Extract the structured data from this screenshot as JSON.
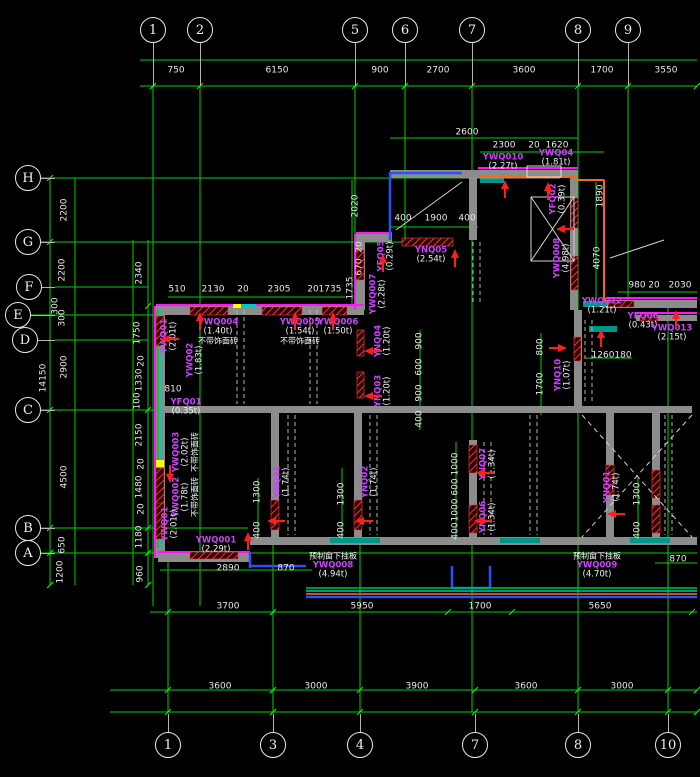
{
  "title": "precast-panel-floor-plan",
  "colors": {
    "background": "#000000",
    "grid_green": "#00d200",
    "wall_gray": "#8c8c8c",
    "wall_magenta": "#ff14ff",
    "label_purple": "#cf3fff",
    "dim_white": "#e8e8e8",
    "arrow_red": "#ff1e1e",
    "accent_blue": "#2850ff",
    "accent_orange": "#ff6414",
    "accent_cyan": "#00c8c8",
    "accent_yellow": "#ffff00"
  },
  "axes": {
    "top": [
      {
        "label": "1",
        "x": 153
      },
      {
        "label": "2",
        "x": 200
      },
      {
        "label": "5",
        "x": 355
      },
      {
        "label": "6",
        "x": 405
      },
      {
        "label": "7",
        "x": 472
      },
      {
        "label": "8",
        "x": 578
      },
      {
        "label": "9",
        "x": 628
      }
    ],
    "bottom": [
      {
        "label": "1",
        "x": 168
      },
      {
        "label": "3",
        "x": 273
      },
      {
        "label": "4",
        "x": 360
      },
      {
        "label": "7",
        "x": 475
      },
      {
        "label": "8",
        "x": 578
      },
      {
        "label": "10",
        "x": 668
      }
    ],
    "left": [
      {
        "label": "H",
        "x": 28,
        "y": 178
      },
      {
        "label": "G",
        "x": 28,
        "y": 242
      },
      {
        "label": "F",
        "x": 29,
        "y": 287
      },
      {
        "label": "E",
        "x": 18,
        "y": 315
      },
      {
        "label": "D",
        "x": 25,
        "y": 340
      },
      {
        "label": "C",
        "x": 28,
        "y": 410
      },
      {
        "label": "B",
        "x": 28,
        "y": 528
      },
      {
        "label": "A",
        "x": 28,
        "y": 553
      }
    ]
  },
  "dims": [
    {
      "t": "750",
      "x": 176,
      "y": 71
    },
    {
      "t": "6150",
      "x": 277,
      "y": 71
    },
    {
      "t": "900",
      "x": 380,
      "y": 71
    },
    {
      "t": "2700",
      "x": 438,
      "y": 71
    },
    {
      "t": "3600",
      "x": 524,
      "y": 71
    },
    {
      "t": "1700",
      "x": 602,
      "y": 71
    },
    {
      "t": "3550",
      "x": 666,
      "y": 71
    },
    {
      "t": "2600",
      "x": 467,
      "y": 133
    },
    {
      "t": "2300",
      "x": 504,
      "y": 146
    },
    {
      "t": "20",
      "x": 534,
      "y": 146
    },
    {
      "t": "1620",
      "x": 557,
      "y": 146
    },
    {
      "t": "400",
      "x": 403,
      "y": 219
    },
    {
      "t": "1900",
      "x": 436,
      "y": 219
    },
    {
      "t": "400",
      "x": 467,
      "y": 219
    },
    {
      "t": "510",
      "x": 177,
      "y": 290
    },
    {
      "t": "2130",
      "x": 213,
      "y": 290
    },
    {
      "t": "20",
      "x": 243,
      "y": 290
    },
    {
      "t": "2305",
      "x": 279,
      "y": 290
    },
    {
      "t": "20",
      "x": 313,
      "y": 290
    },
    {
      "t": "1735",
      "x": 330,
      "y": 290
    },
    {
      "t": "1735",
      "x": 351,
      "y": 288,
      "r": 1
    },
    {
      "t": "980",
      "x": 637,
      "y": 286
    },
    {
      "t": "20",
      "x": 654,
      "y": 286
    },
    {
      "t": "2030",
      "x": 680,
      "y": 286
    },
    {
      "t": "1260",
      "x": 603,
      "y": 356
    },
    {
      "t": "180",
      "x": 623,
      "y": 356
    },
    {
      "t": "810",
      "x": 173,
      "y": 390
    },
    {
      "t": "2890",
      "x": 228,
      "y": 569
    },
    {
      "t": "870",
      "x": 286,
      "y": 569
    },
    {
      "t": "870",
      "x": 678,
      "y": 560
    },
    {
      "t": "3700",
      "x": 228,
      "y": 607
    },
    {
      "t": "5950",
      "x": 362,
      "y": 607
    },
    {
      "t": "1700",
      "x": 480,
      "y": 607
    },
    {
      "t": "5650",
      "x": 600,
      "y": 607
    },
    {
      "t": "3600",
      "x": 220,
      "y": 687
    },
    {
      "t": "3000",
      "x": 316,
      "y": 687
    },
    {
      "t": "3900",
      "x": 417,
      "y": 687
    },
    {
      "t": "3600",
      "x": 526,
      "y": 687
    },
    {
      "t": "3000",
      "x": 622,
      "y": 687
    },
    {
      "t": "2200",
      "x": 65,
      "y": 210,
      "r": 1
    },
    {
      "t": "2200",
      "x": 63,
      "y": 270,
      "r": 1
    },
    {
      "t": "300",
      "x": 56,
      "y": 306,
      "r": 1
    },
    {
      "t": "300",
      "x": 63,
      "y": 318,
      "r": 1
    },
    {
      "t": "2900",
      "x": 65,
      "y": 367,
      "r": 1
    },
    {
      "t": "14150",
      "x": 44,
      "y": 378,
      "r": 1
    },
    {
      "t": "4500",
      "x": 65,
      "y": 477,
      "r": 1
    },
    {
      "t": "650",
      "x": 63,
      "y": 545,
      "r": 1
    },
    {
      "t": "1200",
      "x": 61,
      "y": 572,
      "r": 1
    },
    {
      "t": "2340",
      "x": 140,
      "y": 273,
      "r": 1
    },
    {
      "t": "1750",
      "x": 138,
      "y": 333,
      "r": 1
    },
    {
      "t": "20",
      "x": 142,
      "y": 361,
      "r": 1
    },
    {
      "t": "1330",
      "x": 140,
      "y": 380,
      "r": 1
    },
    {
      "t": "100",
      "x": 138,
      "y": 401,
      "r": 1
    },
    {
      "t": "2150",
      "x": 140,
      "y": 435,
      "r": 1
    },
    {
      "t": "20",
      "x": 142,
      "y": 464,
      "r": 1
    },
    {
      "t": "1480",
      "x": 140,
      "y": 487,
      "r": 1
    },
    {
      "t": "20",
      "x": 142,
      "y": 509,
      "r": 1
    },
    {
      "t": "1180",
      "x": 140,
      "y": 537,
      "r": 1
    },
    {
      "t": "960",
      "x": 141,
      "y": 574,
      "r": 1
    },
    {
      "t": "2020",
      "x": 356,
      "y": 206,
      "r": 1
    },
    {
      "t": "20",
      "x": 360,
      "y": 247,
      "r": 1
    },
    {
      "t": "670",
      "x": 360,
      "y": 267,
      "r": 1
    },
    {
      "t": "1890",
      "x": 601,
      "y": 196,
      "r": 1
    },
    {
      "t": "4070",
      "x": 598,
      "y": 258,
      "r": 1
    },
    {
      "t": "800",
      "x": 541,
      "y": 347,
      "r": 1
    },
    {
      "t": "1700",
      "x": 541,
      "y": 384,
      "r": 1
    },
    {
      "t": "900",
      "x": 420,
      "y": 341,
      "r": 1
    },
    {
      "t": "600",
      "x": 420,
      "y": 367,
      "r": 1
    },
    {
      "t": "900",
      "x": 420,
      "y": 393,
      "r": 1
    },
    {
      "t": "400",
      "x": 420,
      "y": 419,
      "r": 1
    },
    {
      "t": "1300",
      "x": 342,
      "y": 494,
      "r": 1
    },
    {
      "t": "400",
      "x": 342,
      "y": 530,
      "r": 1
    },
    {
      "t": "1000",
      "x": 456,
      "y": 464,
      "r": 1
    },
    {
      "t": "600",
      "x": 456,
      "y": 487,
      "r": 1
    },
    {
      "t": "1000",
      "x": 456,
      "y": 510,
      "r": 1
    },
    {
      "t": "400",
      "x": 456,
      "y": 531,
      "r": 1
    },
    {
      "t": "1300",
      "x": 258,
      "y": 492,
      "r": 1
    },
    {
      "t": "400",
      "x": 258,
      "y": 530,
      "r": 1
    },
    {
      "t": "1300",
      "x": 638,
      "y": 494,
      "r": 1
    },
    {
      "t": "400",
      "x": 638,
      "y": 530,
      "r": 1
    }
  ],
  "panel_labels": [
    {
      "name": "YWQ01",
      "weight": "(2.01t)",
      "x": 170,
      "y": 336,
      "r": 1
    },
    {
      "name": "YWQ004",
      "weight": "(1.40t)",
      "note": "不带饰面砖",
      "x": 218,
      "y": 332
    },
    {
      "name": "YWQ005",
      "weight": "(1.54t)",
      "note": "不带饰面砖",
      "x": 300,
      "y": 332
    },
    {
      "name": "YWQ006",
      "weight": "(1.50t)",
      "x": 338,
      "y": 328
    },
    {
      "name": "YWQ02",
      "weight": "(1.83t)",
      "x": 196,
      "y": 360,
      "r": 1
    },
    {
      "name": "YFQ01",
      "weight": "(0.35t)",
      "x": 186,
      "y": 408
    },
    {
      "name": "YWQ003",
      "weight": "(2.02t)",
      "note": "不带饰面砖",
      "x": 186,
      "y": 452,
      "r": 1
    },
    {
      "name": "YWQ002",
      "weight": "(1.78t)",
      "note": "不带饰面砖",
      "x": 186,
      "y": 497,
      "r": 1
    },
    {
      "name": "YWQ01",
      "weight": "(2.01t)",
      "x": 171,
      "y": 524,
      "r": 1
    },
    {
      "name": "YWQ001",
      "weight": "(2.29t)",
      "x": 216,
      "y": 546
    },
    {
      "name": "YNQ05",
      "weight": "(2.54t)",
      "x": 431,
      "y": 256
    },
    {
      "name": "YFQ05",
      "weight": "(0.29t)",
      "x": 387,
      "y": 256,
      "r": 1
    },
    {
      "name": "YWQ007",
      "weight": "(2.28t)",
      "x": 379,
      "y": 294,
      "r": 1
    },
    {
      "name": "YWQ010",
      "weight": "(2.27t)",
      "x": 503,
      "y": 163
    },
    {
      "name": "YWQ04",
      "weight": "(1.81t)",
      "x": 556,
      "y": 159
    },
    {
      "name": "YFQ02",
      "weight": "(0.39t)",
      "x": 559,
      "y": 199,
      "r": 1
    },
    {
      "name": "YWQ008",
      "weight": "(4.98t)",
      "x": 563,
      "y": 258,
      "r": 1
    },
    {
      "name": "YWQ012",
      "weight": "(1.21t)",
      "x": 602,
      "y": 307
    },
    {
      "name": "YFQ06",
      "weight": "(0.43t)",
      "x": 643,
      "y": 322
    },
    {
      "name": "YWQ013",
      "weight": "(2.15t)",
      "x": 672,
      "y": 334
    },
    {
      "name": "YNQ10",
      "weight": "(1.07t)",
      "x": 564,
      "y": 375,
      "r": 1
    },
    {
      "name": "YNQ04",
      "weight": "(1.20t)",
      "x": 384,
      "y": 341,
      "r": 1
    },
    {
      "name": "YNQ03",
      "weight": "(1.20t)",
      "x": 384,
      "y": 391,
      "r": 1
    },
    {
      "name": "YNQ01",
      "weight": "(1.74t)",
      "x": 283,
      "y": 482,
      "r": 1
    },
    {
      "name": "YNQ02",
      "weight": "(1.74t)",
      "x": 371,
      "y": 482,
      "r": 1
    },
    {
      "name": "YNQ07",
      "weight": "(1.34t)",
      "x": 489,
      "y": 464,
      "r": 1
    },
    {
      "name": "YNQ06",
      "weight": "(1.34t)",
      "x": 489,
      "y": 517,
      "r": 1
    },
    {
      "name": "YNQ01",
      "weight": "(1.74t)",
      "x": 613,
      "y": 487,
      "r": 1
    },
    {
      "noteTop": "预制窗下挂板",
      "name": "YWQ008",
      "weight": "(4.94t)",
      "x": 333,
      "y": 566
    },
    {
      "noteTop": "预制窗下挂板",
      "name": "YWQ009",
      "weight": "(4.70t)",
      "x": 597,
      "y": 566
    }
  ],
  "arrows": [
    {
      "x": 170,
      "y": 339,
      "d": "left"
    },
    {
      "x": 200,
      "y": 321,
      "d": "up"
    },
    {
      "x": 295,
      "y": 321,
      "d": "up"
    },
    {
      "x": 333,
      "y": 321,
      "d": "up"
    },
    {
      "x": 383,
      "y": 263,
      "d": "up"
    },
    {
      "x": 455,
      "y": 258,
      "d": "up"
    },
    {
      "x": 505,
      "y": 189,
      "d": "up"
    },
    {
      "x": 548,
      "y": 191,
      "d": "up"
    },
    {
      "x": 565,
      "y": 229,
      "d": "left"
    },
    {
      "x": 601,
      "y": 338,
      "d": "up"
    },
    {
      "x": 558,
      "y": 348,
      "d": "right"
    },
    {
      "x": 676,
      "y": 319,
      "d": "up"
    },
    {
      "x": 373,
      "y": 351,
      "d": "left"
    },
    {
      "x": 373,
      "y": 396,
      "d": "left"
    },
    {
      "x": 276,
      "y": 521,
      "d": "left"
    },
    {
      "x": 364,
      "y": 521,
      "d": "left"
    },
    {
      "x": 485,
      "y": 473,
      "d": "left"
    },
    {
      "x": 483,
      "y": 521,
      "d": "left"
    },
    {
      "x": 616,
      "y": 514,
      "d": "left"
    },
    {
      "x": 248,
      "y": 541,
      "d": "up"
    },
    {
      "x": 170,
      "y": 474,
      "d": "down"
    }
  ]
}
